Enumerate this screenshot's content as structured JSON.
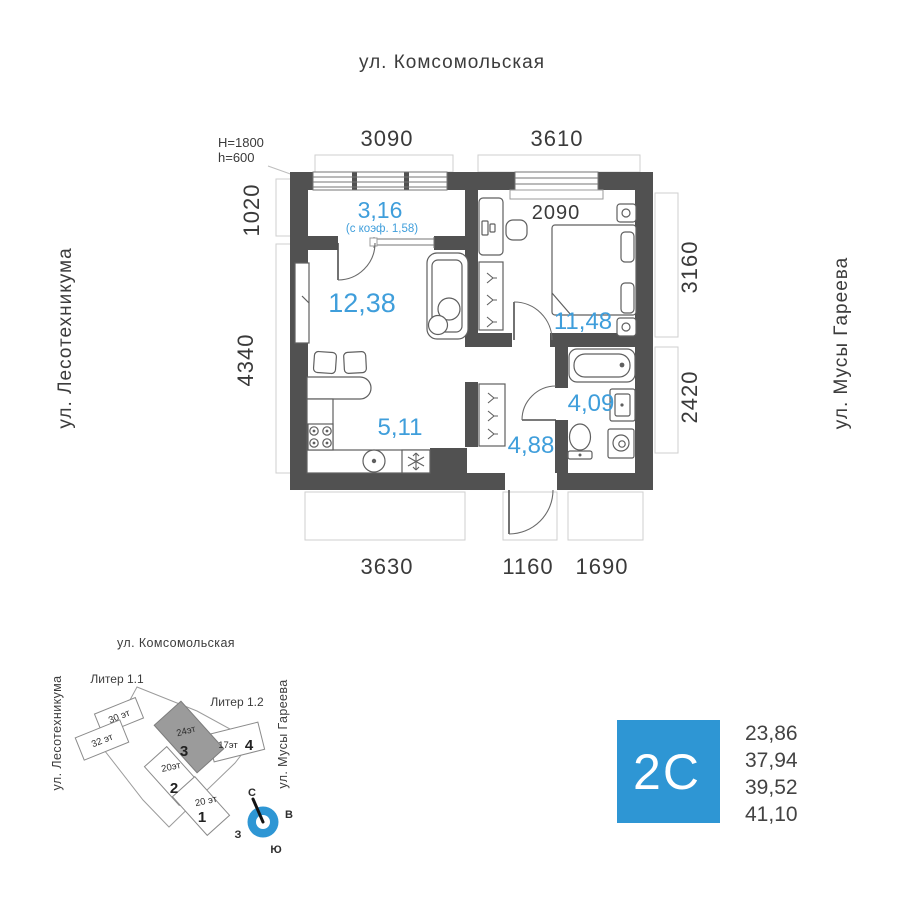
{
  "plan": {
    "street_top": "ул. Комсомольская",
    "street_left": "ул. Лесотехникума",
    "street_right": "ул. Мусы Гареева",
    "dims": {
      "top_left": "3090",
      "top_right": "3610",
      "left_top": "1020",
      "left_bottom": "4340",
      "right_top": "3160",
      "right_bottom": "2420",
      "bottom_left": "3630",
      "bottom_center": "1160",
      "bottom_right": "1690",
      "bedroom_inner": "2090"
    },
    "parapet": {
      "line1": "H=1800",
      "line2": "h=600"
    },
    "rooms": {
      "balcony": {
        "area": "3,16",
        "note": "(с коэф. 1,58)"
      },
      "living": {
        "area": "12,38"
      },
      "bedroom": {
        "area": "11,48"
      },
      "kitchen": {
        "area": "5,11"
      },
      "hall": {
        "area": "4,88"
      },
      "bathroom": {
        "area": "4,09"
      }
    }
  },
  "site": {
    "street_top": "ул. Комсомольская",
    "street_left": "ул. Лесотехникума",
    "street_right": "ул. Мусы Гареева",
    "liter_11": "Литер 1.1",
    "liter_12": "Литер 1.2",
    "buildings": {
      "b30": {
        "floors": "30 эт"
      },
      "b32": {
        "floors": "32 эт"
      },
      "b3": {
        "floors": "24эт",
        "number": "3"
      },
      "b4": {
        "floors": "17эт",
        "number": "4"
      },
      "b2": {
        "floors": "20эт",
        "number": "2"
      },
      "b1": {
        "floors": "20 эт",
        "number": "1"
      }
    },
    "compass": {
      "n": "С",
      "e": "В",
      "s": "Ю",
      "w": "З"
    }
  },
  "legend": {
    "type": "2С",
    "areas": [
      "23,86",
      "37,94",
      "39,52",
      "41,10"
    ]
  },
  "colors": {
    "wall": "#515151",
    "area_blue": "#3f9edb",
    "legend_blue": "#2e96d4",
    "text_dark": "#3a3a3a"
  }
}
